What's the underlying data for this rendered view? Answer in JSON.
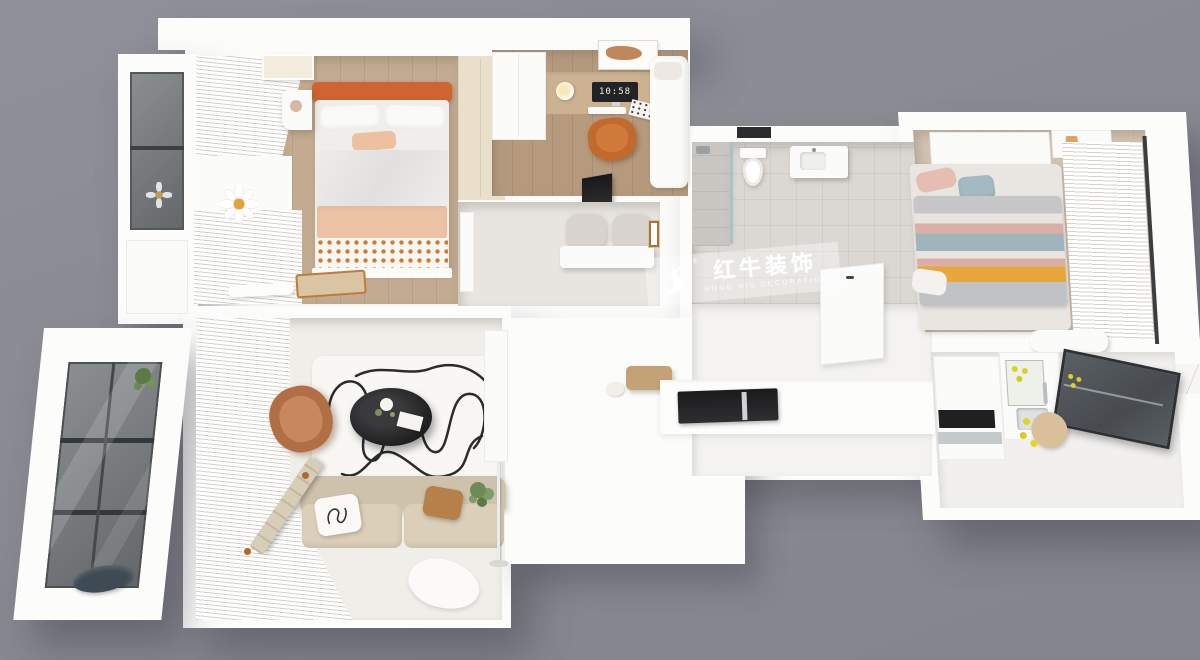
{
  "scene": {
    "description": "3D top-down render of an apartment floor plan on grey background",
    "background_color": "#8a8a92",
    "wall_color": "#fcfcfb",
    "accent_orange": "#cf6332",
    "wood_floor": "#c2ab90",
    "stripe_yellow": "#e5a33d",
    "stripe_blue": "#9fb4bd",
    "stripe_pink": "#dcafa6",
    "lemon_yellow": "#ddd21f"
  },
  "watermark": {
    "logo": "bull-icon",
    "registered": "®",
    "title": "红牛装饰",
    "subtitle": "HONG NIU DECORATION"
  },
  "study": {
    "monitor_clock": "10:58"
  },
  "rooms": [
    {
      "name": "master-bedroom"
    },
    {
      "name": "north-balcony"
    },
    {
      "name": "study"
    },
    {
      "name": "dining-nook"
    },
    {
      "name": "bathroom"
    },
    {
      "name": "hallway-kitchen-corridor"
    },
    {
      "name": "second-bedroom"
    },
    {
      "name": "kitchen"
    },
    {
      "name": "living-room"
    },
    {
      "name": "south-balcony"
    }
  ]
}
